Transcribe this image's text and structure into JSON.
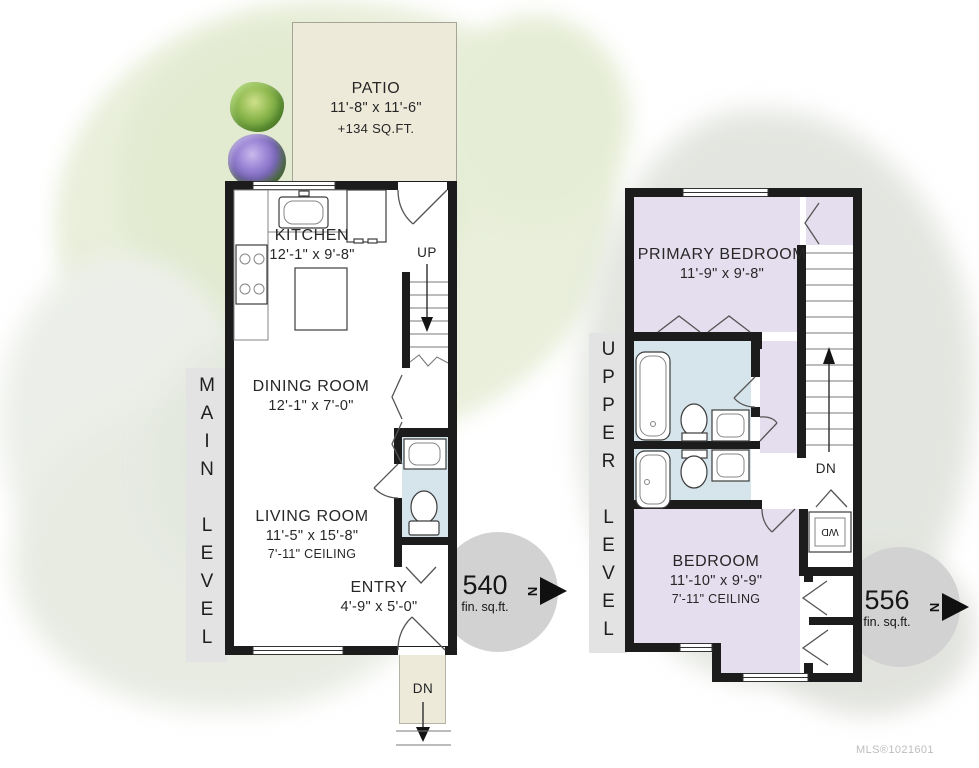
{
  "colors": {
    "wall": "#1c1c1c",
    "patio_fill": "#edeada",
    "bedroom_fill": "#e5deee",
    "bath_fill": "#d6e4ec",
    "badge_fill": "#d2d2d2",
    "level_bar_fill": "#e3e3e3"
  },
  "watermark": "MLS®1021601",
  "main_level": {
    "label": "MAIN LEVEL",
    "area_value": "540",
    "area_unit": "fin. sq.ft.",
    "north_label": "N",
    "patio": {
      "name": "PATIO",
      "dims": "11'-8\" x 11'-6\"",
      "area": "+134 SQ.FT."
    },
    "kitchen": {
      "name": "KITCHEN",
      "dims": "12'-1\" x 9'-8\""
    },
    "dining": {
      "name": "DINING ROOM",
      "dims": "12'-1\" x 7'-0\""
    },
    "living": {
      "name": "LIVING ROOM",
      "dims": "11'-5\" x 15'-8\"",
      "ceiling": "7'-11\" CEILING"
    },
    "entry": {
      "name": "ENTRY",
      "dims": "4'-9\" x 5'-0\""
    },
    "stairs_up": "UP",
    "stairs_dn": "DN"
  },
  "upper_level": {
    "label": "UPPER LEVEL",
    "area_value": "556",
    "area_unit": "fin. sq.ft.",
    "north_label": "N",
    "primary_bedroom": {
      "name": "PRIMARY BEDROOM",
      "dims": "11'-9\" x 9'-8\""
    },
    "bedroom": {
      "name": "BEDROOM",
      "dims": "11'-10\" x 9'-9\"",
      "ceiling": "7'-11\" CEILING"
    },
    "stairs_dn": "DN",
    "washer_dryer": "WD"
  }
}
